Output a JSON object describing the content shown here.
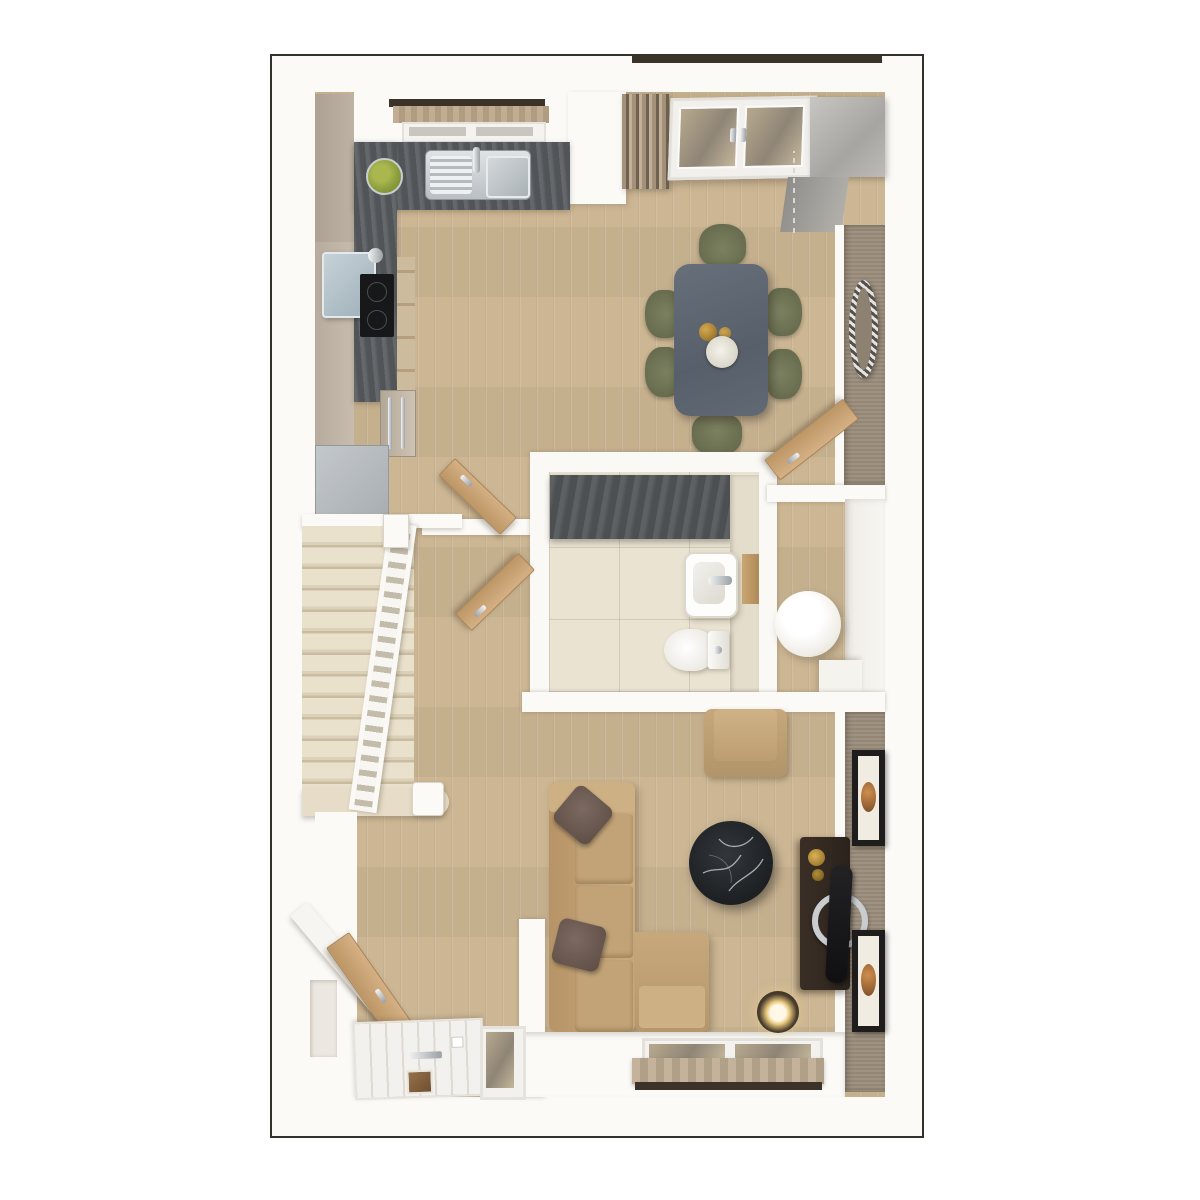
{
  "scene": {
    "kind": "3d-top-down-floor-plan",
    "floor": "ground-floor-apartment",
    "rooms": [
      "kitchen",
      "dining-area",
      "hallway",
      "staircase",
      "wc-bathroom",
      "storage-room",
      "living-room",
      "entrance-vestibule"
    ]
  },
  "counts": {
    "dining_chairs": 6,
    "stair_treads": 13,
    "wall_art_frames": 2,
    "windows": 2,
    "open_interior_doors": 4,
    "sofa_cushions": 2
  },
  "palette": {
    "frame_dark": "#34312d",
    "floor_wood": "#ccb693",
    "wall_white": "#fbfaf7",
    "counter_dark": "#585c60",
    "cabinet_beige": "#b5aa9c",
    "appliance_silver": "#b6babd",
    "hob_black": "#17181a",
    "stairs_carpet": "#e6dcc7",
    "sofa_tan": "#c2a377",
    "cushion_brown": "#6e5b53",
    "chair_olive": "#6f7456",
    "dining_table_gray": "#5d6570",
    "taupe_wall": "#9a8c7b",
    "marble_black": "#232629",
    "door_wood": "#c79f72",
    "tile_cream": "#eae3d2",
    "feature_wall_dark": "#53575a",
    "valance_tan": "#bcab92",
    "lintel_brown": "#3b332a",
    "art_orange": "#c07a3c",
    "brass": "#b8923a"
  }
}
